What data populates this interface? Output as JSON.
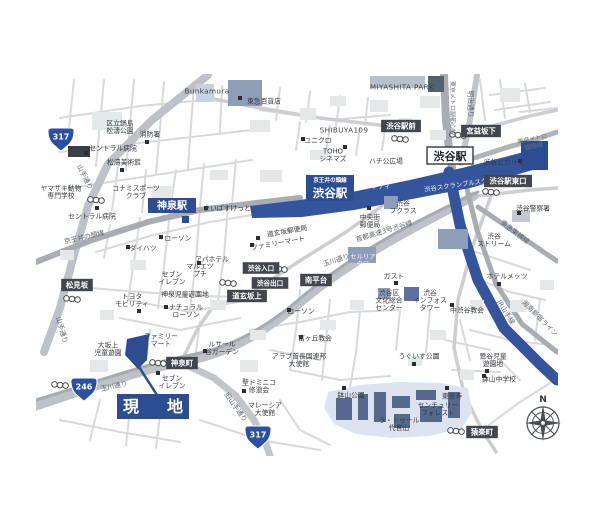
{
  "map": {
    "colors": {
      "accent_navy": "#2d4d92",
      "station_band": "#34549c",
      "road_grey": "#bec1c5",
      "expressway_grey": "#a6abb1",
      "rail_grey": "#a9adb2",
      "estate_blue": "#dde4f0",
      "building_slate": "#8e9db8",
      "box_dark": "#43474d"
    },
    "site": {
      "label": "現　地"
    },
    "stations": {
      "shinsen": "神泉駅",
      "keio_line": "京王井の頭線",
      "keio_shibuya": "渋谷駅",
      "jr_shibuya": "渋谷駅"
    },
    "compass": {
      "north": "N"
    },
    "shields": [
      {
        "num": "317",
        "x": 61,
        "y": 139
      },
      {
        "num": "246",
        "x": 84,
        "y": 389
      },
      {
        "num": "317",
        "x": 258,
        "y": 437
      }
    ],
    "intersections": [
      {
        "x": 401,
        "y": 126,
        "text": "渋谷駅前"
      },
      {
        "x": 481,
        "y": 131,
        "text": "宮益坂下"
      },
      {
        "x": 508,
        "y": 181,
        "text": "渋谷駅東口"
      },
      {
        "x": 247,
        "y": 296,
        "text": "道玄坂上"
      },
      {
        "x": 316,
        "y": 280,
        "text": "南平台"
      },
      {
        "x": 77,
        "y": 285,
        "text": "松見坂"
      },
      {
        "x": 182,
        "y": 363,
        "text": "神泉町"
      },
      {
        "x": 482,
        "y": 432,
        "text": "猿楽町"
      },
      {
        "x": 261,
        "y": 268,
        "text": "渋谷入口",
        "small": true
      },
      {
        "x": 270,
        "y": 283,
        "text": "渋谷出口",
        "small": true
      }
    ],
    "pois": [
      {
        "x": 207,
        "y": 91,
        "lines": [
          "Bunkamura"
        ],
        "cls": "latin"
      },
      {
        "x": 264,
        "y": 101,
        "lines": [
          "東急百貨店"
        ],
        "bullet": [
          240,
          98
        ]
      },
      {
        "x": 402,
        "y": 87,
        "lines": [
          "MIYASHITA PARK"
        ],
        "cls": "latin"
      },
      {
        "x": 120,
        "y": 127,
        "lines": [
          "区立鍋島",
          "松濤公園"
        ]
      },
      {
        "x": 150,
        "y": 134,
        "lines": [
          "消防署"
        ],
        "bullet": [
          147,
          142
        ]
      },
      {
        "x": 113,
        "y": 148,
        "lines": [
          "セントラル病院"
        ],
        "bullet": [
          86,
          153
        ]
      },
      {
        "x": 124,
        "y": 162,
        "lines": [
          "松濤美術館"
        ],
        "bullet": [
          122,
          170
        ]
      },
      {
        "x": 61,
        "y": 192,
        "lines": [
          "ヤマザキ動物",
          "専門学校"
        ]
      },
      {
        "x": 136,
        "y": 192,
        "lines": [
          "コナミスポーツ",
          "クラブ"
        ]
      },
      {
        "x": 92,
        "y": 216,
        "lines": [
          "セントラル病院"
        ],
        "bullet": [
          97,
          208
        ]
      },
      {
        "x": 344,
        "y": 130,
        "lines": [
          "SHIBUYA109"
        ],
        "cls": "latin"
      },
      {
        "x": 318,
        "y": 140,
        "lines": [
          "ユニクロ"
        ],
        "bullet": [
          303,
          139
        ]
      },
      {
        "x": 333,
        "y": 155,
        "lines": [
          "TOHO",
          "シネマズ"
        ],
        "bullet": [
          345,
          147
        ]
      },
      {
        "x": 386,
        "y": 161,
        "lines": [
          "ハチ公広場"
        ]
      },
      {
        "x": 381,
        "y": 182,
        "lines": [
          "渋谷マーク",
          "シティ"
        ],
        "cls": "white-sm"
      },
      {
        "x": 462,
        "y": 184,
        "lines": [
          "渋谷スクランブルスクエア"
        ],
        "cls": "white-sm",
        "rot": -8
      },
      {
        "x": 504,
        "y": 162,
        "lines": [
          "渋谷ヒカリエ"
        ],
        "bullet": [
          520,
          161
        ]
      },
      {
        "x": 533,
        "y": 208,
        "lines": [
          "渋谷警察署"
        ],
        "bullet": [
          519,
          213
        ]
      },
      {
        "x": 494,
        "y": 240,
        "lines": [
          "渋谷",
          "ストリーム"
        ]
      },
      {
        "x": 507,
        "y": 276,
        "lines": [
          "ホテルメッツ"
        ],
        "bullet": [
          499,
          284
        ]
      },
      {
        "x": 370,
        "y": 221,
        "lines": [
          "中央街",
          "郵便局"
        ],
        "bullet": [
          369,
          208
        ]
      },
      {
        "x": 403,
        "y": 207,
        "lines": [
          "渋谷",
          "フクラス"
        ]
      },
      {
        "x": 287,
        "y": 231,
        "lines": [
          "道玄坂郵便局"
        ],
        "rot": -10,
        "bullet": [
          258,
          238
        ]
      },
      {
        "x": 278,
        "y": 243,
        "lines": [
          "ファミリーマート"
        ],
        "rot": -10,
        "bullet": [
          252,
          245
        ]
      },
      {
        "x": 394,
        "y": 276,
        "lines": [
          "ガスト"
        ],
        "bullet": [
          396,
          283
        ]
      },
      {
        "x": 389,
        "y": 300,
        "lines": [
          "渋谷区",
          "文化総合",
          "センター"
        ]
      },
      {
        "x": 430,
        "y": 300,
        "lines": [
          "渋谷",
          "インフォス",
          "タワー"
        ]
      },
      {
        "x": 467,
        "y": 310,
        "lines": [
          "中渋谷教会"
        ],
        "bullet": [
          452,
          305
        ]
      },
      {
        "x": 366,
        "y": 260,
        "lines": [
          "セルリアン",
          "タワー"
        ],
        "cls": "white-sm"
      },
      {
        "x": 227,
        "y": 208,
        "lines": [
          "まいばすけっと"
        ],
        "bullet": [
          206,
          208
        ]
      },
      {
        "x": 178,
        "y": 238,
        "lines": [
          "ローソン"
        ],
        "bullet": [
          161,
          237
        ]
      },
      {
        "x": 143,
        "y": 248,
        "lines": [
          "ダイハツ"
        ],
        "bullet": [
          128,
          247
        ]
      },
      {
        "x": 212,
        "y": 259,
        "lines": [
          "アパホテル"
        ],
        "bullet": [
          199,
          263
        ]
      },
      {
        "x": 200,
        "y": 270,
        "lines": [
          "マルエツ",
          "プチ"
        ]
      },
      {
        "x": 172,
        "y": 278,
        "lines": [
          "セブン",
          "イレブン"
        ]
      },
      {
        "x": 132,
        "y": 300,
        "lines": [
          "トヨタ",
          "モビリティ"
        ],
        "bullet": [
          139,
          311
        ]
      },
      {
        "x": 185,
        "y": 294,
        "lines": [
          "神泉児童遊園地"
        ]
      },
      {
        "x": 186,
        "y": 311,
        "lines": [
          "ナチュラル",
          "ローソン"
        ],
        "bullet": [
          166,
          307
        ]
      },
      {
        "x": 161,
        "y": 340,
        "lines": [
          "ファミリー",
          "マート"
        ]
      },
      {
        "x": 108,
        "y": 349,
        "lines": [
          "大坂上",
          "児童遊園"
        ]
      },
      {
        "x": 172,
        "y": 382,
        "lines": [
          "セブン",
          "イレブン"
        ],
        "bullet": [
          158,
          373
        ]
      },
      {
        "x": 222,
        "y": 348,
        "lines": [
          "ルサール",
          "谷ガーデン"
        ],
        "bullet": [
          205,
          351
        ]
      },
      {
        "x": 259,
        "y": 386,
        "lines": [
          "聖ドミニコ",
          "修道会"
        ],
        "bullet": [
          244,
          391
        ]
      },
      {
        "x": 265,
        "y": 409,
        "lines": [
          "マレーシア",
          "大使館"
        ]
      },
      {
        "x": 299,
        "y": 360,
        "lines": [
          "アラブ首長国連邦",
          "大使館"
        ]
      },
      {
        "x": 315,
        "y": 338,
        "lines": [
          "富ヶ丘教会"
        ],
        "bullet": [
          301,
          337
        ]
      },
      {
        "x": 301,
        "y": 311,
        "lines": [
          "ローソン"
        ],
        "bullet": [
          289,
          310
        ]
      },
      {
        "x": 419,
        "y": 356,
        "lines": [
          "うぐいす公園"
        ],
        "bullet": [
          414,
          364
        ]
      },
      {
        "x": 493,
        "y": 360,
        "lines": [
          "鶯谷児童",
          "遊園地"
        ],
        "bullet": [
          487,
          371
        ]
      },
      {
        "x": 499,
        "y": 379,
        "lines": [
          "鉢山中学校"
        ],
        "bullet": [
          484,
          376
        ]
      },
      {
        "x": 452,
        "y": 396,
        "lines": [
          "東泉寺"
        ],
        "bullet": [
          447,
          388
        ]
      },
      {
        "x": 438,
        "y": 409,
        "lines": [
          "センチュリー",
          "フォレスト"
        ]
      },
      {
        "x": 399,
        "y": 424,
        "lines": [
          "ラ・トゥール",
          "代官山"
        ]
      },
      {
        "x": 351,
        "y": 395,
        "lines": [
          "鉢山公園"
        ],
        "bullet": [
          344,
          388
        ]
      }
    ],
    "road_labels": [
      {
        "x": 471,
        "y": 104,
        "lines": [
          "明治通り"
        ],
        "rot": 90,
        "cls": "road"
      },
      {
        "x": 453,
        "y": 108,
        "lines": [
          "東京メトロ副都心線"
        ],
        "rot": 90,
        "cls": "road-sm"
      },
      {
        "x": 533,
        "y": 142,
        "lines": [
          "東京メトロ",
          "銀座線"
        ],
        "rot": -12,
        "cls": "road-sm"
      },
      {
        "x": 515,
        "y": 232,
        "lines": [
          "東急東横線"
        ],
        "rot": 38,
        "cls": "road"
      },
      {
        "x": 506,
        "y": 312,
        "lines": [
          "JR山手線"
        ],
        "rot": 58,
        "cls": "road"
      },
      {
        "x": 540,
        "y": 318,
        "lines": [
          "湘南新宿ライン"
        ],
        "rot": 45,
        "cls": "road"
      },
      {
        "x": 384,
        "y": 231,
        "lines": [
          "首都高速3号渋谷線"
        ],
        "rot": -17,
        "cls": "road"
      },
      {
        "x": 336,
        "y": 260,
        "lines": [
          "玉川通り"
        ],
        "rot": -17,
        "cls": "road"
      },
      {
        "x": 114,
        "y": 386,
        "lines": [
          "玉川通り"
        ],
        "rot": -12,
        "cls": "road"
      },
      {
        "x": 85,
        "y": 177,
        "lines": [
          "山手通り"
        ],
        "rot": 64,
        "cls": "road"
      },
      {
        "x": 62,
        "y": 330,
        "lines": [
          "山手通り"
        ],
        "rot": 75,
        "cls": "road"
      },
      {
        "x": 236,
        "y": 407,
        "lines": [
          "旧山手通り"
        ],
        "rot": 55,
        "cls": "road"
      },
      {
        "x": 84,
        "y": 237,
        "lines": [
          "京王井の頭線"
        ],
        "rot": -13,
        "cls": "road"
      }
    ],
    "crossings": [
      [
        400,
        139
      ],
      [
        458,
        135
      ],
      [
        491,
        192
      ],
      [
        228,
        283
      ],
      [
        279,
        269
      ],
      [
        72,
        299
      ],
      [
        158,
        363
      ],
      [
        60,
        385
      ],
      [
        456,
        431
      ],
      [
        96,
        200
      ]
    ]
  }
}
